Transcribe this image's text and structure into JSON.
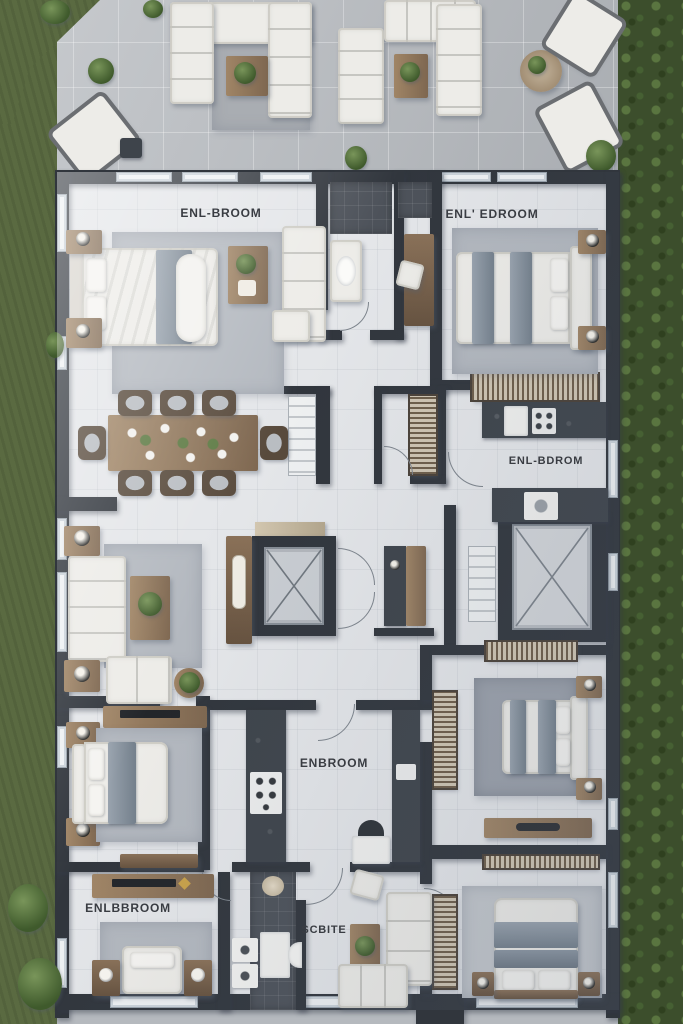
{
  "meta": {
    "type": "architectural floor plan",
    "view": "top-down 3d render",
    "style": "photoreal apartment plan with furniture, surrounded by lawn and hedges"
  },
  "labels": {
    "bedroom_top_left": "ENL-BROOM",
    "bedroom_top_right": "ENL' EDROOM",
    "kitchen_mid_right": "ENL-BDROM",
    "kitchen_center": "ENBROOM",
    "bedroom_bottom_left": "ENLBBROOM",
    "suite_bottom_center": "SCBITE"
  },
  "rooms": [
    {
      "id": "terrace",
      "label": "",
      "furniture": [
        "l-shaped-outdoor-sofa",
        "outdoor-sofa",
        "chaise-lounge",
        "chaise-lounge",
        "coffee-table",
        "round-table",
        "potted-plants"
      ]
    },
    {
      "id": "bedroom-top-left",
      "label": "ENL-BROOM",
      "furniture": [
        "double-bed",
        "nightstand-with-lamp",
        "nightstand-with-lamp",
        "area-rug",
        "coffee-table",
        "sofa",
        "ottoman"
      ]
    },
    {
      "id": "bathroom-top-center",
      "label": "",
      "furniture": [
        "shower",
        "vanity-sink"
      ]
    },
    {
      "id": "hallway-top",
      "label": "",
      "furniture": [
        "console-table",
        "chair"
      ]
    },
    {
      "id": "bedroom-top-right",
      "label": "ENL' EDROOM",
      "furniture": [
        "double-bed",
        "nightstand-with-lamp",
        "nightstand-with-lamp",
        "area-rug",
        "slatted-dresser"
      ]
    },
    {
      "id": "dining-room",
      "label": "",
      "furniture": [
        "dining-table",
        "eight-chairs",
        "staircase"
      ]
    },
    {
      "id": "walk-in-closet",
      "label": "",
      "furniture": [
        "slatted-shelving"
      ]
    },
    {
      "id": "kitchen-mid-right",
      "label": "ENL-BDROM",
      "furniture": [
        "counter-with-stove",
        "fridge",
        "washer",
        "counter"
      ]
    },
    {
      "id": "elevator-core",
      "label": "",
      "furniture": [
        "elevator-shaft",
        "console-table",
        "decor-candelabra"
      ]
    },
    {
      "id": "hall-mid",
      "label": "",
      "furniture": [
        "desk",
        "doors"
      ]
    },
    {
      "id": "skylight-core",
      "label": "",
      "furniture": [
        "skylight-shaft",
        "staircase"
      ]
    },
    {
      "id": "living-mid-left",
      "label": "",
      "furniture": [
        "sofa",
        "loveseat",
        "coffee-table",
        "side-table-with-lamp",
        "side-table-with-lamp",
        "plant-stand",
        "area-rug"
      ]
    },
    {
      "id": "bedroom-mid-left",
      "label": "",
      "furniture": [
        "double-bed",
        "dresser-with-tv",
        "nightstand-with-lamp",
        "nightstand-with-lamp",
        "bench",
        "area-rug"
      ]
    },
    {
      "id": "kitchen-center",
      "label": "ENBROOM",
      "furniture": [
        "counter-with-stove",
        "counter",
        "sink-fixture"
      ]
    },
    {
      "id": "bedroom-mid-right",
      "label": "",
      "furniture": [
        "double-bed",
        "bookshelf",
        "bookshelf",
        "desk",
        "nightstand-with-lamp",
        "nightstand-with-lamp",
        "area-rug"
      ]
    },
    {
      "id": "bedroom-bottom-left",
      "label": "ENLBBROOM",
      "furniture": [
        "bed",
        "dresser-with-tv",
        "nightstand",
        "nightstand",
        "area-rug"
      ]
    },
    {
      "id": "bathroom-bottom",
      "label": "",
      "furniture": [
        "stacked-washer",
        "vanity",
        "round-sink"
      ]
    },
    {
      "id": "suite-bottom-center",
      "label": "SCBITE",
      "furniture": [
        "sectional-sofa",
        "sofa",
        "armchair",
        "coffee-table"
      ]
    },
    {
      "id": "bedroom-bottom-right",
      "label": "",
      "furniture": [
        "double-bed",
        "slatted-wardrobe",
        "nightstand",
        "nightstand",
        "area-rug"
      ]
    }
  ],
  "palette": {
    "wall": "#31363d",
    "floor": "#e4e6e9",
    "terrace": "#b4b8bd",
    "lawn": "#5a6a41",
    "hedge": "#3c4e2c",
    "rug": "#b3b8bf",
    "wood": "#8d7459",
    "upholstery": "#edece8",
    "textile_gray": "#7d89: #7d8995",
    "counter_dark": "#3e444b",
    "label_text": "#393c42"
  }
}
